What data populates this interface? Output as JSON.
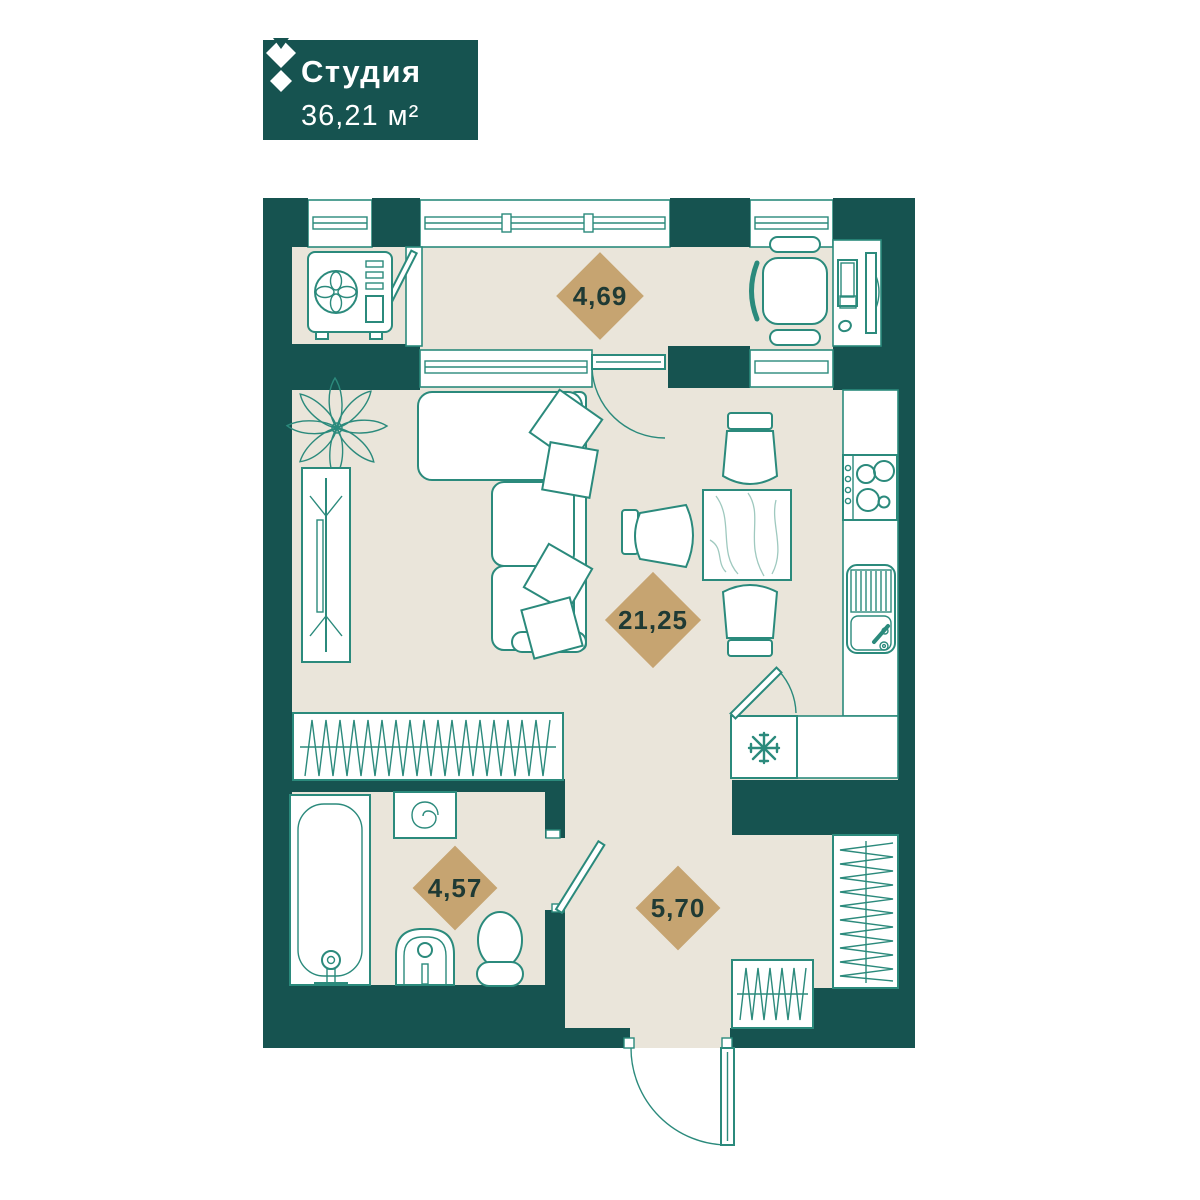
{
  "title_card": {
    "type_label": "Студия",
    "area_value": "36,21 м²"
  },
  "areas": {
    "loggia": "4,69",
    "living_kitchen": "21,25",
    "bathroom": "4,57",
    "hallway": "5,70"
  },
  "colors": {
    "wall": "#165350",
    "floor": "#eae5da",
    "fixture_line": "#2b8a7c",
    "area_badge": "#c6a471",
    "badge_text": "#1f3a34",
    "card_background": "#165350",
    "card_text": "#ffffff"
  }
}
